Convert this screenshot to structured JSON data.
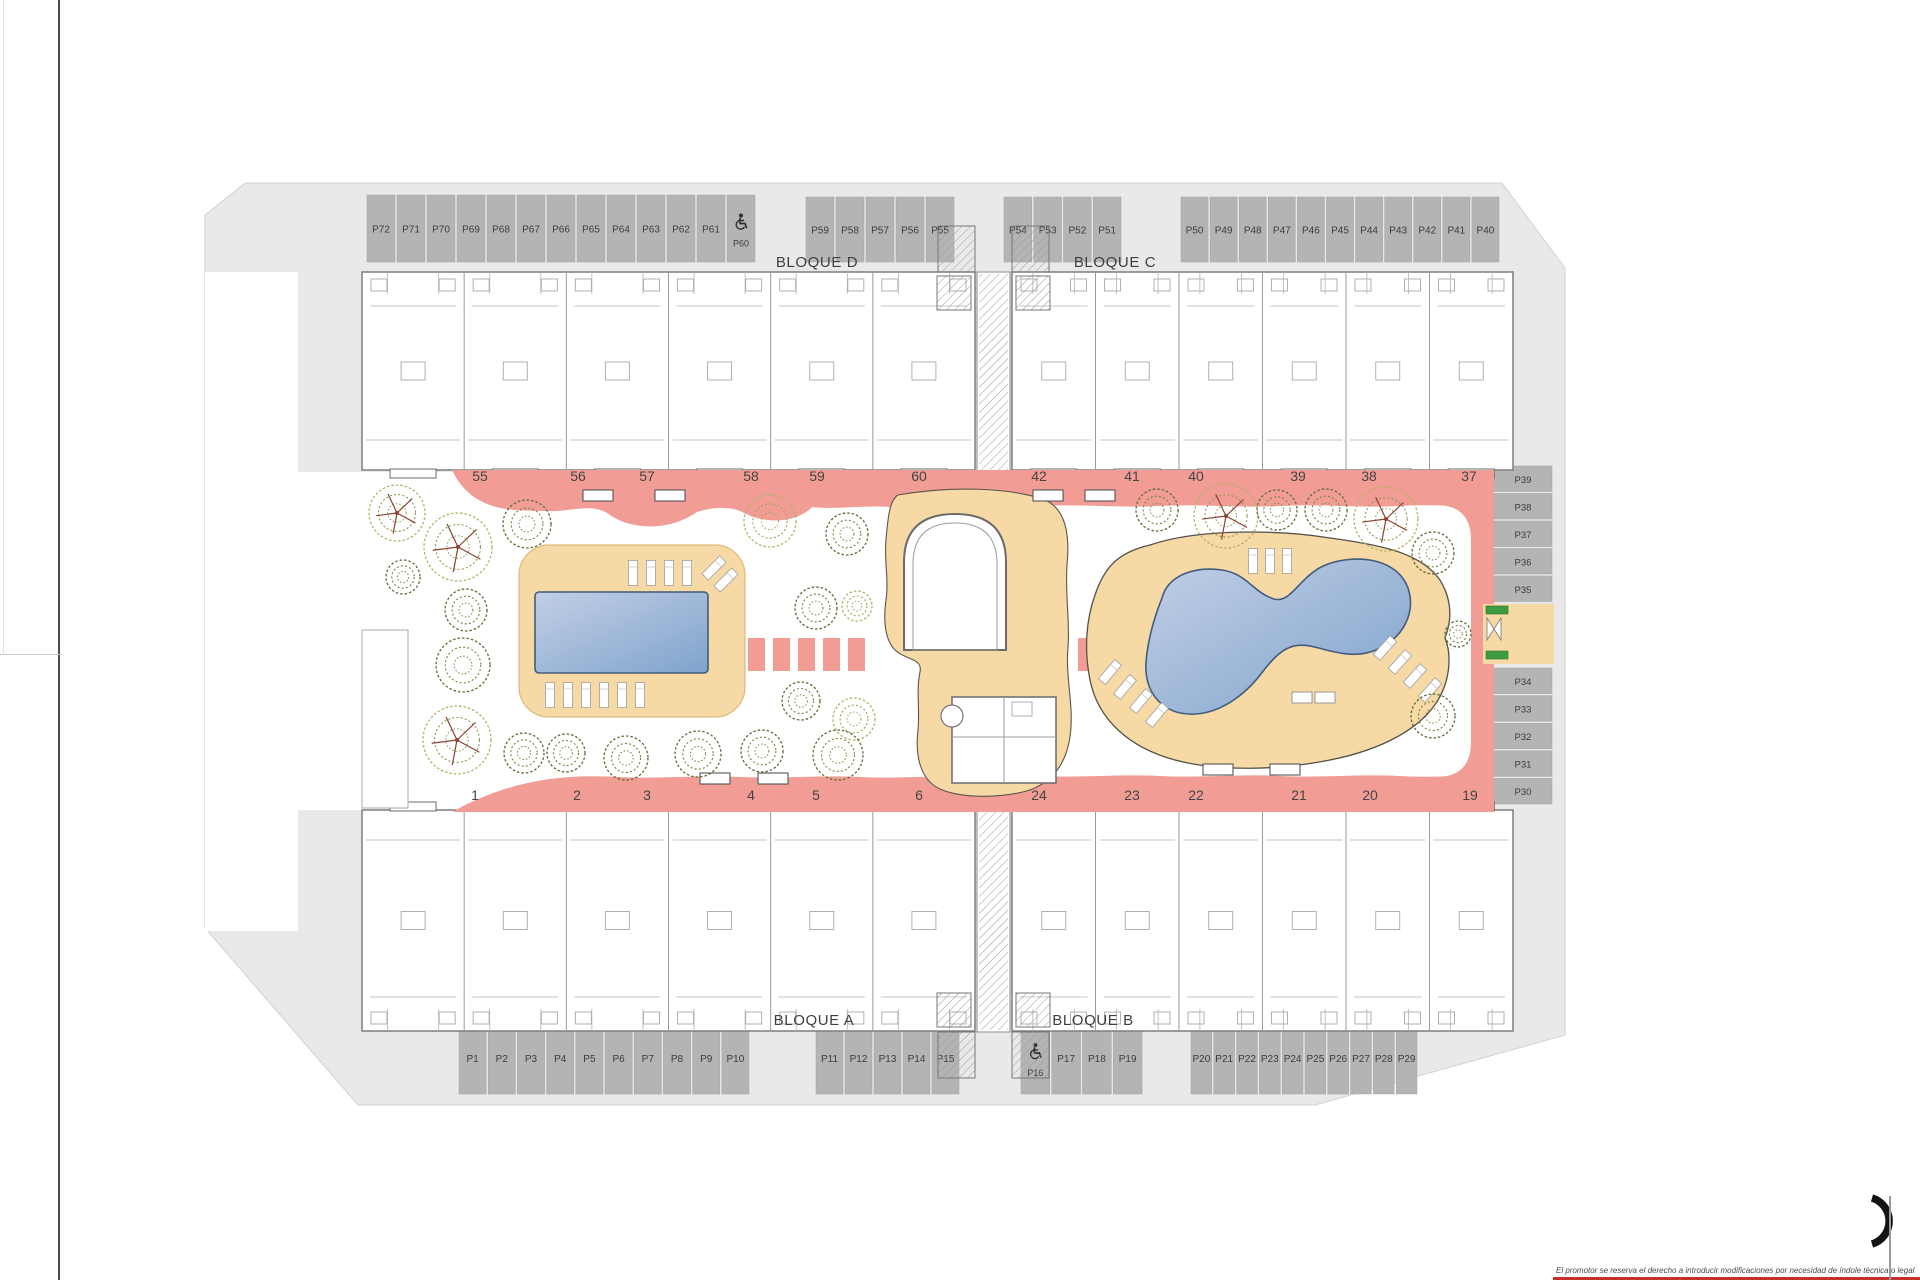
{
  "plan": {
    "block_labels": {
      "top_left": "BLOQUE D",
      "top_right": "BLOQUE C",
      "bottom_left": "BLOQUE A",
      "bottom_right": "BLOQUE B"
    },
    "disclaimer": "El promotor se reserva el derecho a introducir modificaciones por necesidad de índole técnica o legal",
    "unit_numbers_top": [
      "55",
      "56",
      "57",
      "58",
      "59",
      "60",
      "42",
      "41",
      "40",
      "39",
      "38",
      "37"
    ],
    "unit_numbers_bottom": [
      "1",
      "2",
      "3",
      "4",
      "5",
      "6",
      "24",
      "23",
      "22",
      "21",
      "20",
      "19"
    ],
    "parking": {
      "top_row_groups": [
        {
          "stalls": [
            "P72",
            "P71",
            "P70",
            "P69",
            "P68",
            "P67",
            "P66",
            "P65",
            "P64",
            "P63",
            "P62",
            "P61",
            "P60"
          ],
          "accessible": [
            "P60"
          ]
        },
        {
          "stalls": [
            "P59",
            "P58",
            "P57",
            "P56",
            "P55"
          ],
          "accessible": []
        },
        {
          "stalls": [
            "P54",
            "P53",
            "P52",
            "P51"
          ],
          "accessible": []
        },
        {
          "stalls": [
            "P50",
            "P49",
            "P48",
            "P47",
            "P46",
            "P45",
            "P44",
            "P43",
            "P42",
            "P41",
            "P40"
          ],
          "accessible": []
        }
      ],
      "bottom_row_groups": [
        {
          "stalls": [
            "P1",
            "P2",
            "P3",
            "P4",
            "P5",
            "P6",
            "P7",
            "P8",
            "P9",
            "P10"
          ],
          "accessible": []
        },
        {
          "stalls": [
            "P11",
            "P12",
            "P13",
            "P14",
            "P15"
          ],
          "accessible": []
        },
        {
          "stalls": [
            "P16",
            "P17",
            "P18",
            "P19"
          ],
          "accessible": [
            "P16"
          ]
        },
        {
          "stalls": [
            "P20",
            "P21",
            "P22",
            "P23",
            "P24",
            "P25",
            "P26",
            "P27",
            "P28",
            "P29"
          ],
          "accessible": []
        }
      ],
      "right_column_groups": [
        {
          "stalls": [
            "P39",
            "P38",
            "P37",
            "P36",
            "P35"
          ],
          "accessible": []
        },
        {
          "stalls": [
            "P34",
            "P33",
            "P32",
            "P31",
            "P30"
          ],
          "accessible": []
        }
      ]
    },
    "colors": {
      "walkway_pink": "#f19d95",
      "deck_sand": "#f6d9a5",
      "pool_blue_light": "#c2cfe6",
      "pool_blue_deep": "#7fa3cc",
      "pavement": "#e9e9e9",
      "stall_gray": "#b4b4b4",
      "tree_olive": "#5d6c33",
      "tree_yellow": "#b3b264",
      "tree_branch": "#8a4331",
      "sign_green": "#3f9b3f",
      "accent_red": "#c62f2a"
    }
  }
}
